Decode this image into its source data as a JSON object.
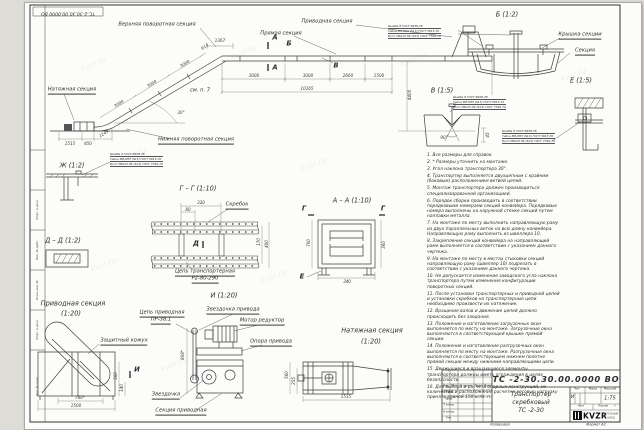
{
  "sheet": {
    "watermark": "kvzr.ru",
    "corner_stamp": "ТС-2-30.30.00.0000 ВО",
    "copied": "Копировал",
    "format": "Формат А2",
    "side_labels": [
      "Подп. и дата",
      "Инв. № дубл.",
      "Взам. инв. №",
      "Подп. и дата",
      "Инв. № подл."
    ]
  },
  "main_view": {
    "labels": {
      "upper_turn": "Верхняя поворотная секция",
      "drive": "Приводная секция",
      "straight": "Прямая секция",
      "tension": "Натяжная секция",
      "lower_turn": "Нижняя поворотная секция",
      "see_note": "см. п. 7"
    },
    "markers": {
      "a": "А",
      "b": "Б",
      "v": "В"
    },
    "dims": {
      "h1": "3000",
      "h2": "3000",
      "h3": "2660",
      "h4": "1500",
      "total": "10165",
      "i1": "3000",
      "i2": "3000",
      "i3": "3000",
      "i4": "615",
      "i5": "1367",
      "l1": "1515",
      "l2": "850",
      "l3": "1249",
      "angle": "30°",
      "height": "4400"
    }
  },
  "fasteners": {
    "washer": "Шайба 8 ГОСТ 6958-78",
    "nut": "Гайка М8-6Н5 (S13) ГОСТ 5915-70",
    "bolt": "Болт М8х25.58 (S13) ГОСТ 7796-70"
  },
  "views": {
    "b": {
      "title": "Б (1:2)",
      "cover": "Крышка секции",
      "section": "Секция"
    },
    "e": {
      "title": "Е (1:5)"
    },
    "v": {
      "title": "В (1:5)",
      "angle": "90°",
      "thickness": "45"
    },
    "zh": {
      "title": "Ж (1:2)"
    },
    "dd": {
      "title": "Д – Д (1:2)"
    },
    "gg": {
      "title": "Г – Г (1:10)",
      "scraper": "Скребок",
      "marker": "Д",
      "chain1": "Цепь транспортерная",
      "chain2": "Р2-80-290",
      "d1": "320",
      "d2": "80",
      "d3": "170",
      "d4": "400"
    },
    "aa": {
      "title": "А – А (1:10)",
      "marker_g": "Г",
      "marker_e": "Е",
      "d1": "700",
      "d2": "340",
      "d3": "360"
    },
    "drive": {
      "title": "Приводная секция",
      "scale": "(1:20)",
      "guard": "Защитный кожух",
      "marker": "И",
      "d1": "780*",
      "d2": "1500",
      "d3": "560",
      "d4": "140"
    },
    "i": {
      "title": "И (1:20)",
      "chain1": "Цепь приводная",
      "chain2": "ПР-38,1",
      "sprocket_drive": "Звездочка привода",
      "motor": "Мотор редуктор",
      "support": "Опора привода",
      "sprocket": "Звездочка",
      "section": "Секция приводная",
      "d1": "808*"
    },
    "tension": {
      "title": "Натяжная секция",
      "scale": "(1:20)",
      "d1": "1515",
      "d2": "255",
      "d3": "560"
    }
  },
  "notes": [
    "1. Все размеры для справок.",
    "2. * Размеры уточнить на монтаже.",
    "3. Угол наклона транспортера 30°.",
    "4. Транспортер выполняется двухцепным с крайним (боковым) расположением ветвей цепей.",
    "5. Монтаж транспортера должен производиться специализированной организацией.",
    "6. Порядок сборки производить в соответствии порядковыми номерами секций конвейера. Порядковые номера выполнены на наружной стенке секций путем наплавки металла.",
    "7. На монтаже по месту выполнить направляющую раму из двух параллельных веток на всю длину конвейера. Направляющую раму выполнить из швеллера 10.",
    "8. Закрепление секций конвейера на направляющей раме выполняется в соответствии с указанием данного чертежа.",
    "9. На монтаже по месту в местах стыковки секций направляющую раму (швеллер 10) подрезать в соответствии с указанием данного чертежа.",
    "10. Не допускается изменение заводского угла наклона транспортера путем изменения конфигурации поворотных секций.",
    "11. После установки транспортерных и приводной цепей и установки скребков на транспортерные цепи необходимо произвести их натяжение.",
    "12. Вращение валов и движение цепей должно происходить без заедания.",
    "13. Положение и изготовление загрузочных окон выполняется по месту на монтаже. Загрузочные окна выполняются в соответствующей крышке прямой секции.",
    "14. Положение и изготовление разгрузочных окон выполняется по месту на монтаже. Разгрузочные окна выполняются в соответствующем нижнем полотне прямой секции между нижними направляющими цепи.",
    "15. Движущиеся и вращающиеся элементы транспортера должны иметь ограждения в целях безопасности.",
    "16. Для выбора и расчета опорных конструкций, их количество и расположения расчетно-весовую нагрузку принять равной 150 кг/м. п."
  ],
  "title_block": {
    "doc_number": "ТС -2-30.30.00.0000  ВО",
    "name1": "Транспортер",
    "name2": "скребковый",
    "name3": "ТС -2-30",
    "lit": "Лит.",
    "mass": "Масса",
    "scale_h": "Масштаб",
    "lit_value": "И",
    "scale_value": "1:75",
    "sheet": "Лист",
    "sheets": "Листов",
    "sheets_value": "1",
    "rev0": "Изм.",
    "rev1": "Лист",
    "rev2": "№ докум.",
    "rev3": "Подп.",
    "rev4": "Дата",
    "sign0": "Разраб.",
    "sign1": "Пров.",
    "sign2": "Т.контр.",
    "sign3": "Н.контр.",
    "sign4": "Утв.",
    "logo": "KVZR",
    "logo_sub1": "КОТЕЛЬНЫЙ",
    "logo_sub2": "ЗАВОД"
  }
}
